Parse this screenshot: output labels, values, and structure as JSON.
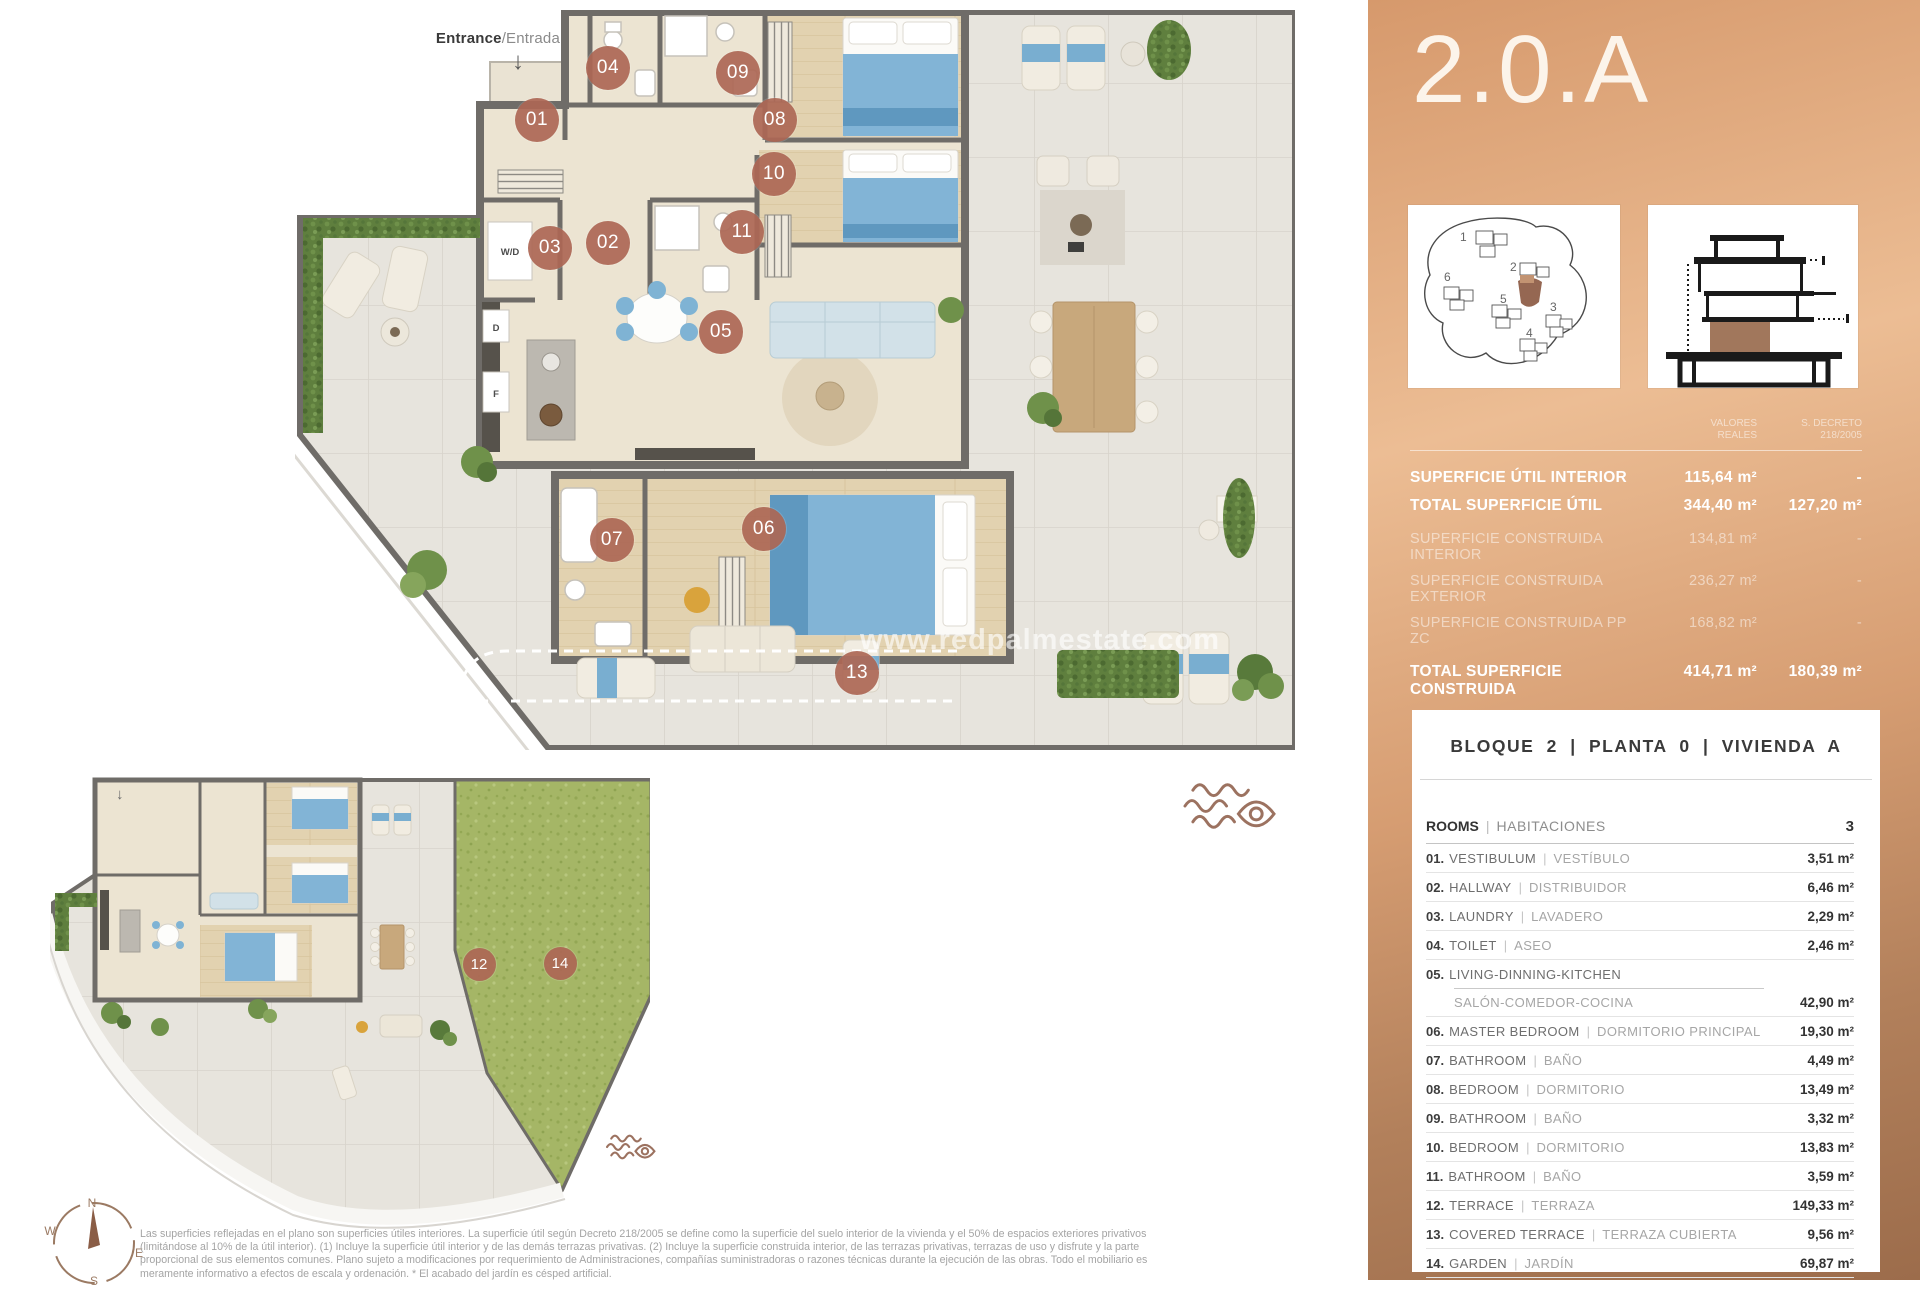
{
  "plan": {
    "entrance_bold": "Entrance",
    "entrance_light": "/Entrada",
    "arrow_down": "↓",
    "wd": "W/D",
    "d": "D",
    "f": "F",
    "watermark": "www.redpalmestate.com",
    "main_badges": [
      {
        "n": "01",
        "x": 242,
        "y": 110
      },
      {
        "n": "02",
        "x": 313,
        "y": 233
      },
      {
        "n": "03",
        "x": 255,
        "y": 238
      },
      {
        "n": "04",
        "x": 313,
        "y": 58
      },
      {
        "n": "05",
        "x": 426,
        "y": 322
      },
      {
        "n": "06",
        "x": 469,
        "y": 519
      },
      {
        "n": "07",
        "x": 317,
        "y": 530
      },
      {
        "n": "08",
        "x": 480,
        "y": 110
      },
      {
        "n": "09",
        "x": 443,
        "y": 63
      },
      {
        "n": "10",
        "x": 479,
        "y": 164
      },
      {
        "n": "11",
        "x": 447,
        "y": 222
      },
      {
        "n": "13",
        "x": 562,
        "y": 663
      }
    ],
    "small_badges": [
      {
        "n": "12",
        "x": 429,
        "y": 189
      },
      {
        "n": "14",
        "x": 510,
        "y": 188
      }
    ]
  },
  "sidebar": {
    "title": "2.0.A",
    "site_plan_numbers": [
      "1",
      "6",
      "2",
      "5",
      "3",
      "4"
    ],
    "col_headers": [
      {
        "l1": "VALORES",
        "l2": "REALES"
      },
      {
        "l1": "S. DECRETO",
        "l2": "218/2005"
      }
    ],
    "surfaces": [
      {
        "label": "SUPERFICIE ÚTIL INTERIOR",
        "v1": "115,64 m²",
        "v2": "-",
        "strong": true
      },
      {
        "label": "TOTAL SUPERFICIE ÚTIL",
        "v1": "344,40 m²",
        "v2": "127,20 m²",
        "strong": true
      },
      {
        "label": "SUPERFICIE CONSTRUIDA INTERIOR",
        "v1": "134,81 m²",
        "v2": "-",
        "strong": false,
        "gap": true
      },
      {
        "label": "SUPERFICIE CONSTRUIDA EXTERIOR",
        "v1": "236,27 m²",
        "v2": "-",
        "strong": false
      },
      {
        "label": "SUPERFICIE CONSTRUIDA PP ZC",
        "v1": "168,82 m²",
        "v2": "-",
        "strong": false
      },
      {
        "label": "TOTAL SUPERFICIE CONSTRUIDA",
        "v1": "414,71 m²",
        "v2": "180,39 m²",
        "strong": true,
        "gap": true
      }
    ],
    "block_header": "BLOQUE 2  |  PLANTA 0  |  VIVIENDA A",
    "rooms_header": {
      "en": "ROOMS",
      "sep": "|",
      "es": "HABITACIONES",
      "count": "3"
    },
    "rooms": [
      {
        "num": "01.",
        "en": "VESTIBULUM",
        "es": "VESTÍBULO",
        "value": "3,51 m²"
      },
      {
        "num": "02.",
        "en": "HALLWAY",
        "es": "DISTRIBUIDOR",
        "value": "6,46 m²"
      },
      {
        "num": "03.",
        "en": "LAUNDRY",
        "es": "LAVADERO",
        "value": "2,29 m²"
      },
      {
        "num": "04.",
        "en": "TOILET",
        "es": "ASEO",
        "value": "2,46 m²"
      },
      {
        "num": "05.",
        "en": "LIVING-DINNING-KITCHEN",
        "es": "SALÓN-COMEDOR-COCINA",
        "value": "42,90 m²",
        "stacked": true
      },
      {
        "num": "06.",
        "en": "MASTER BEDROOM",
        "es": "DORMITORIO PRINCIPAL",
        "value": "19,30 m²"
      },
      {
        "num": "07.",
        "en": "BATHROOM",
        "es": "BAÑO",
        "value": "4,49 m²"
      },
      {
        "num": "08.",
        "en": "BEDROOM",
        "es": "DORMITORIO",
        "value": "13,49 m²"
      },
      {
        "num": "09.",
        "en": "BATHROOM",
        "es": "BAÑO",
        "value": "3,32 m²"
      },
      {
        "num": "10.",
        "en": "BEDROOM",
        "es": "DORMITORIO",
        "value": "13,83 m²"
      },
      {
        "num": "11.",
        "en": "BATHROOM",
        "es": "BAÑO",
        "value": "3,59 m²"
      },
      {
        "num": "12.",
        "en": "TERRACE",
        "es": "TERRAZA",
        "value": "149,33 m²"
      },
      {
        "num": "13.",
        "en": "COVERED TERRACE",
        "es": "TERRAZA CUBIERTA",
        "value": "9,56 m²"
      },
      {
        "num": "14.",
        "en": "GARDEN",
        "es": "JARDÍN",
        "value": "69,87 m²"
      }
    ]
  },
  "compass": {
    "n": "N",
    "e": "E",
    "s": "S",
    "w": "W"
  },
  "footer": {
    "lines": [
      "Las superficies reflejadas en el plano son superficies útiles interiores. La superficie útil según Decreto 218/2005 se define como la superficie del suelo interior de la vivienda y el 50% de espacios exteriores privativos",
      "(limitándose al 10% de la útil interior). (1) Incluye la superficie útil interior y de las demás terrazas privativas. (2) Incluye la superficie construida interior, de las terrazas privativas, terrazas de uso y disfrute y la parte",
      "proporcional de sus elementos comunes. Plano sujeto a modificaciones por requerimiento de Administraciones, compañías suministradoras o razones técnicas durante la ejecución de las obras. Todo el mobiliario es",
      "meramente informativo a efectos de escala y ordenación. * El acabado del jardín es césped artificial."
    ]
  }
}
